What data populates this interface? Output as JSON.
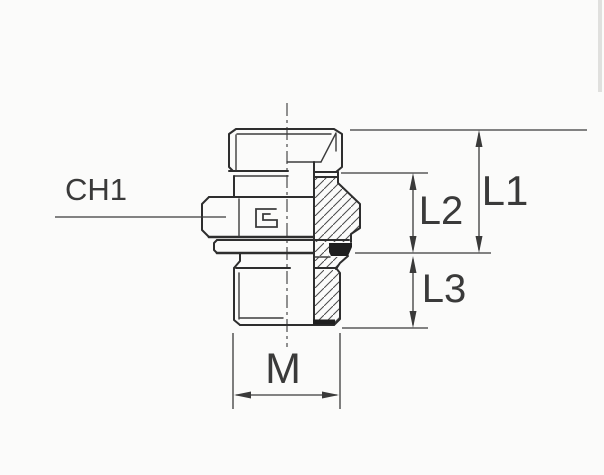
{
  "drawing": {
    "type": "technical-drawing-half-section",
    "labels": {
      "ch1": "CH1",
      "l1": "L1",
      "l2": "L2",
      "l3": "L3",
      "m": "M"
    },
    "colors": {
      "outline": "#2e2e2e",
      "dimension": "#3a3a3a",
      "text": "#3a3a3a",
      "seal": "#1f1f1f",
      "hatch": "#4a4a4a",
      "background": "#fbfbfa"
    }
  }
}
